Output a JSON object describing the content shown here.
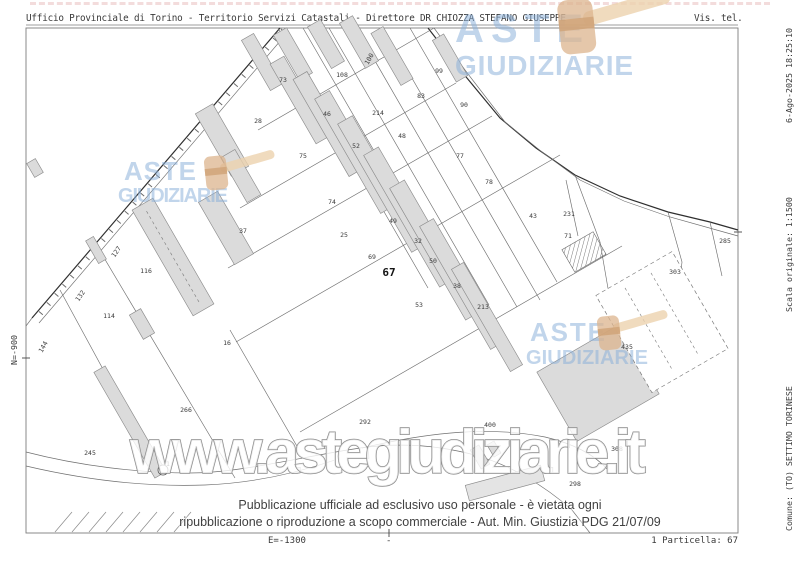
{
  "header": {
    "left": "Ufficio Provinciale di Torino - Territorio Servizi Catastali - Direttore DR CHIOZZA STEFANO GIUSEPPE",
    "right": "Vis. tel."
  },
  "left_margin": {
    "north_coord": "N=-900"
  },
  "footer": {
    "east_coord": "E=-1300",
    "center_tick": "-",
    "parcel_ref": "1 Particella: 67"
  },
  "right_margin": {
    "line1": {
      "start": "Comune: (TO) SETTIMO TORINESE",
      "middle": "Scala originale: 1:1500",
      "end": "6-Ago-2025 18:25:10"
    },
    "line2": {
      "start": "Foglio: 44",
      "end": "Dimensione cornice: 400.500 X 283.500 m. Protocollo pratica T251964/2025"
    }
  },
  "disclaimer": {
    "line1": "Pubblicazione ufficiale ad esclusivo uso personale - è vietata ogni",
    "line2": "ripubblicazione o riproduzione a scopo commerciale - Aut. Min. Giustizia PDG 21/07/09"
  },
  "watermarks": {
    "logo_word_1": "ASTE",
    "logo_word_2": "GIUDIZIARIE",
    "url": "www.astegiudiziarie.it",
    "logo_color": "#88aed8",
    "gavel_color": "#dcb48e"
  },
  "map": {
    "highlight_parcel": "67",
    "parcel_labels": [
      {
        "t": "73",
        "x": 283,
        "y": 82
      },
      {
        "t": "108",
        "x": 342,
        "y": 77
      },
      {
        "t": "100",
        "x": 371,
        "y": 60,
        "r": -60
      },
      {
        "t": "99",
        "x": 439,
        "y": 73
      },
      {
        "t": "83",
        "x": 421,
        "y": 98
      },
      {
        "t": "90",
        "x": 464,
        "y": 107
      },
      {
        "t": "28",
        "x": 258,
        "y": 123
      },
      {
        "t": "46",
        "x": 327,
        "y": 116
      },
      {
        "t": "214",
        "x": 378,
        "y": 115
      },
      {
        "t": "48",
        "x": 402,
        "y": 138
      },
      {
        "t": "52",
        "x": 356,
        "y": 148
      },
      {
        "t": "75",
        "x": 303,
        "y": 158
      },
      {
        "t": "77",
        "x": 460,
        "y": 158
      },
      {
        "t": "78",
        "x": 489,
        "y": 184
      },
      {
        "t": "74",
        "x": 332,
        "y": 204
      },
      {
        "t": "43",
        "x": 533,
        "y": 218
      },
      {
        "t": "49",
        "x": 393,
        "y": 223
      },
      {
        "t": "25",
        "x": 344,
        "y": 237
      },
      {
        "t": "32",
        "x": 418,
        "y": 243
      },
      {
        "t": "69",
        "x": 372,
        "y": 259
      },
      {
        "t": "50",
        "x": 433,
        "y": 263
      },
      {
        "t": "38",
        "x": 457,
        "y": 288
      },
      {
        "t": "53",
        "x": 419,
        "y": 307
      },
      {
        "t": "213",
        "x": 483,
        "y": 309
      },
      {
        "t": "37",
        "x": 243,
        "y": 233
      },
      {
        "t": "116",
        "x": 146,
        "y": 273
      },
      {
        "t": "114",
        "x": 109,
        "y": 318
      },
      {
        "t": "127",
        "x": 118,
        "y": 253,
        "r": -55
      },
      {
        "t": "132",
        "x": 82,
        "y": 297,
        "r": -55
      },
      {
        "t": "144",
        "x": 45,
        "y": 348,
        "r": -60
      },
      {
        "t": "16",
        "x": 227,
        "y": 345
      },
      {
        "t": "266",
        "x": 186,
        "y": 412
      },
      {
        "t": "245",
        "x": 90,
        "y": 455
      },
      {
        "t": "1",
        "x": 168,
        "y": 466
      },
      {
        "t": "292",
        "x": 365,
        "y": 424
      },
      {
        "t": "400",
        "x": 490,
        "y": 427
      },
      {
        "t": "231",
        "x": 569,
        "y": 216
      },
      {
        "t": "71",
        "x": 568,
        "y": 238
      },
      {
        "t": "285",
        "x": 725,
        "y": 243
      },
      {
        "t": "303",
        "x": 675,
        "y": 274
      },
      {
        "t": "435",
        "x": 627,
        "y": 349
      },
      {
        "t": "308",
        "x": 617,
        "y": 451
      },
      {
        "t": "298",
        "x": 575,
        "y": 486
      },
      {
        "t": "67",
        "x": 389,
        "y": 276,
        "b": true
      }
    ]
  }
}
